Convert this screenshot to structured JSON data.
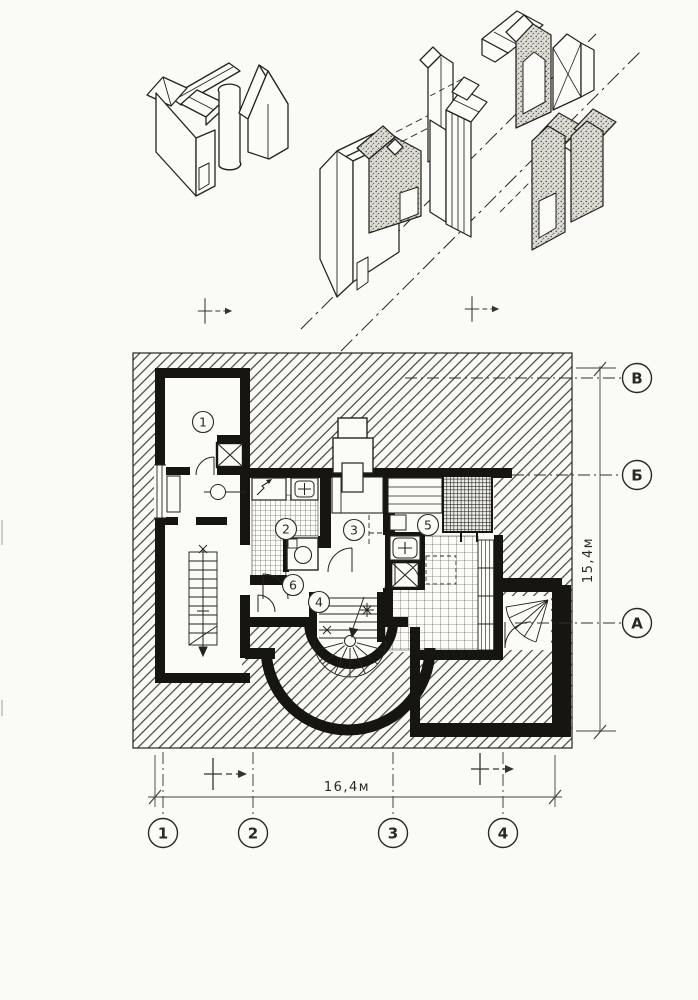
{
  "plan": {
    "room_labels": [
      "1",
      "2",
      "3",
      "4",
      "5",
      "6"
    ],
    "axis_letters": [
      "В",
      "Б",
      "А"
    ],
    "axis_numbers": [
      "1",
      "2",
      "3",
      "4"
    ],
    "dims": {
      "width": "16,4м",
      "height": "15,4м"
    }
  },
  "colors": {
    "ink": "#25231f",
    "paper": "#fafaf6",
    "wall": "#161511"
  }
}
